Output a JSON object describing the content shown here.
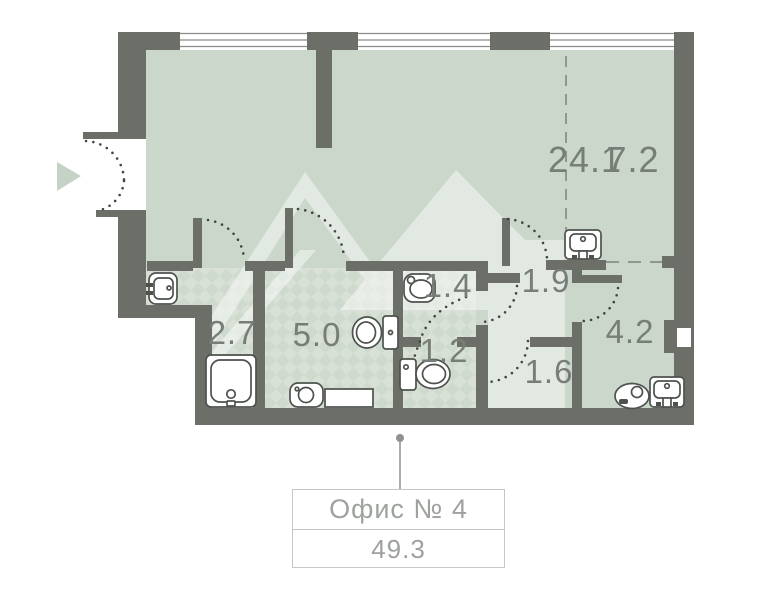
{
  "plan": {
    "rooms": [
      {
        "id": "living",
        "label": "24.1"
      },
      {
        "id": "zone-7-2",
        "label": "7.2"
      },
      {
        "id": "bath-2-7",
        "label": "2.7"
      },
      {
        "id": "bath-5-0",
        "label": "5.0"
      },
      {
        "id": "wc-1-4",
        "label": "1.4"
      },
      {
        "id": "wc-1-2",
        "label": "1.2"
      },
      {
        "id": "hall-1-9",
        "label": "1.9"
      },
      {
        "id": "hall-1-6",
        "label": "1.6"
      },
      {
        "id": "room-4-2",
        "label": "4.2"
      }
    ]
  },
  "label_box": {
    "title": "Офис № 4",
    "area": "49.3"
  },
  "colors": {
    "wall": "#6b6f68",
    "room_fill": "#cbd7cb",
    "tile_light": "#d9e0d5",
    "tile_dark": "#cfdacf",
    "watermark": "#ffffff",
    "room_label_text": "#777d77",
    "box_text": "#9da29d",
    "entrance_arrow": "#c4d3c6",
    "dash_line": "#8f978f",
    "door_arc_dots": "#41463f"
  }
}
